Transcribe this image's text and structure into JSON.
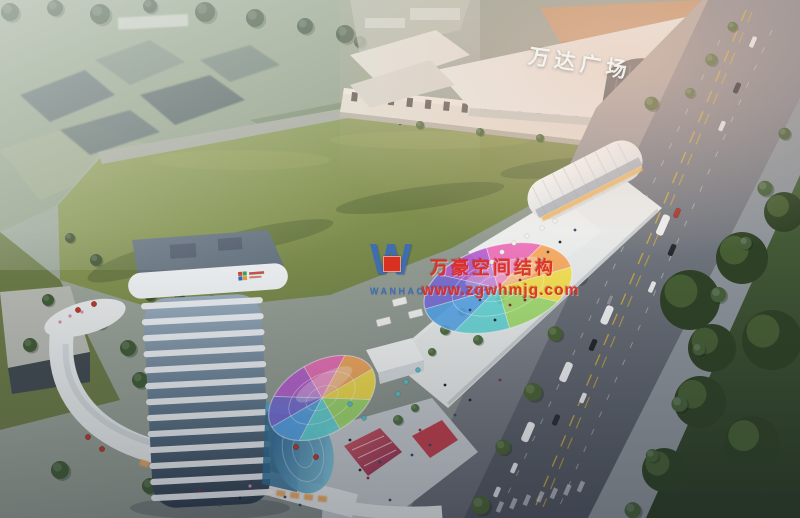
{
  "signs": {
    "mall": "万达广场"
  },
  "watermark": {
    "logo_letter": "W",
    "logo_name": "WANHAO",
    "company": "万豪空间结构",
    "website": "www.zgwhmjg.com"
  },
  "colors": {
    "watermark_red": "#e02b20",
    "watermark_blue": "#3a6db8",
    "sign_white": "#f4f5f2",
    "canopy": [
      "#f6e14a",
      "#9fdc6a",
      "#63d6d6",
      "#58a6e8",
      "#7a6fd8",
      "#b85fd0",
      "#ef6fb8",
      "#f8a85a"
    ],
    "lawn_green": "#81914f",
    "deep_green": "#3f5231",
    "road_gray": "#787e86",
    "tower_white": "#eef2f4",
    "accent_red": "#c0392e",
    "warm_light": "#f0a85c"
  }
}
